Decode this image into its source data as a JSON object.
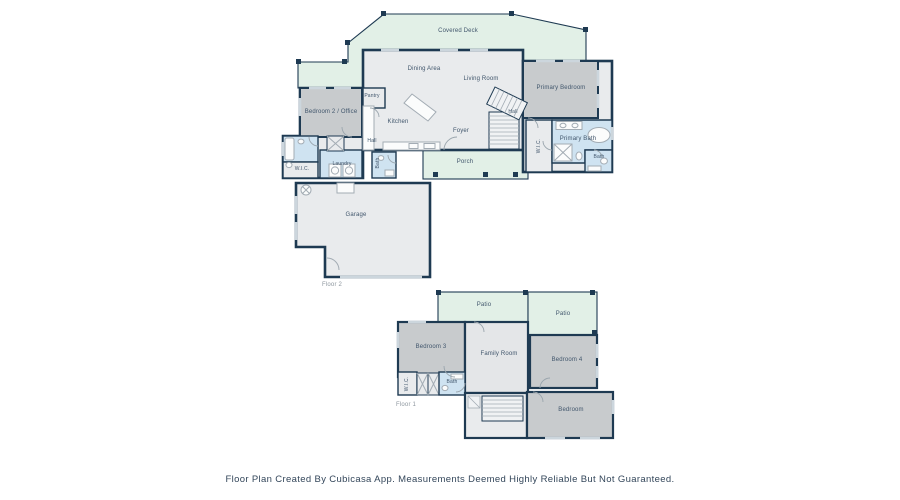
{
  "footer": {
    "text": "Floor Plan Created By Cubicasa App. Measurements Deemed Highly Reliable But Not Guaranteed."
  },
  "colors": {
    "wall": "#1e3a52",
    "outdoor_fill": "#e2f0e7",
    "interior_fill": "#e9ebed",
    "bedroom_fill": "#c8cbcd",
    "bath_fill": "#cfe3f1",
    "label_text": "#41566c"
  },
  "floor2": {
    "label": "Floor 2",
    "rooms": {
      "covered_deck": "Covered Deck",
      "dining_area": "Dining Area",
      "living_room": "Living Room",
      "primary_bedroom": "Primary Bedroom",
      "bedroom2_office": "Bedroom 2 / Office",
      "pantry": "Pantry",
      "kitchen": "Kitchen",
      "foyer": "Foyer",
      "hall": "Hall",
      "hall_upper": "Hall",
      "wic_primary": "W.I.C.",
      "primary_bath": "Primary Bath",
      "bath": "Bath",
      "bath_hall": "Bath",
      "laundry": "Laundry",
      "wic": "W.I.C.",
      "garage": "Garage",
      "porch": "Porch"
    }
  },
  "floor1": {
    "label": "Floor 1",
    "rooms": {
      "patio_left": "Patio",
      "patio_right": "Patio",
      "bedroom3": "Bedroom 3",
      "family_room": "Family Room",
      "bedroom4": "Bedroom 4",
      "wic": "W.I.C.",
      "bath": "Bath",
      "bedroom": "Bedroom"
    }
  }
}
